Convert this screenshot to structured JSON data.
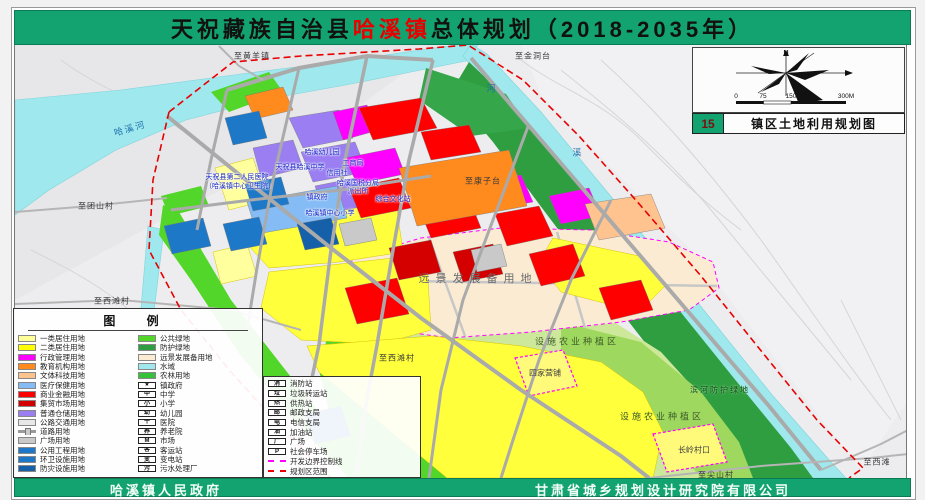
{
  "title": {
    "part1": "天祝藏族自治县",
    "highlight": "哈溪镇",
    "part2": "总体规划（2018-2035年）"
  },
  "footer": {
    "left": "哈溪镇人民政府",
    "right": "甘肃省城乡规划设计研究院有限公司"
  },
  "inset": {
    "north_label": "N",
    "scale_ticks": [
      "0",
      "75",
      "150",
      "300M"
    ],
    "sheet_number": "15",
    "sheet_title": "镇区土地利用规划图"
  },
  "colors": {
    "banner_green": "#12A370",
    "boundary_red": "#E80000",
    "control_line_magenta": "#FF00FF",
    "water_cyan": "#9FE8EE",
    "reserve_cream": "#FBEBD3"
  },
  "legend": {
    "title": "图  例",
    "col1": [
      {
        "label": "一类居住用地",
        "swatch": "#FFFF99"
      },
      {
        "label": "二类居住用地",
        "swatch": "#FFFF00"
      },
      {
        "label": "行政管理用地",
        "swatch": "#FF00FF"
      },
      {
        "label": "教育机构用地",
        "swatch": "#FF8A1E"
      },
      {
        "label": "文体科技用地",
        "swatch": "#FFC390"
      },
      {
        "label": "医疗保健用地",
        "swatch": "#85BCF5"
      },
      {
        "label": "商业金融用地",
        "swatch": "#FF0000"
      },
      {
        "label": "集贸市场用地",
        "swatch": "#D40000"
      },
      {
        "label": "普通仓储用地",
        "swatch": "#9B7FF2"
      },
      {
        "label": "公路交通用地",
        "swatch": "#E8E8E8"
      },
      {
        "label": "道路用地",
        "line": "road"
      },
      {
        "label": "广场用地",
        "swatch": "#C9C9C9"
      },
      {
        "label": "公用工程用地",
        "swatch": "#1E78C8"
      },
      {
        "label": "环卫设施用地",
        "swatch": "#1E78C8"
      },
      {
        "label": "防灾设施用地",
        "swatch": "#1560A8"
      }
    ],
    "col2": [
      {
        "label": "公共绿地",
        "swatch": "#52D629"
      },
      {
        "label": "防护绿地",
        "swatch": "#2F9E41"
      },
      {
        "label": "远景发展备用地",
        "swatch": "#FBEBD3"
      },
      {
        "label": "水域",
        "swatch": "#9FE8EE"
      },
      {
        "label": "农林用地",
        "swatch": "#35C13A"
      },
      {
        "label": "镇政府",
        "icon": "★"
      },
      {
        "label": "中学",
        "icon": "中"
      },
      {
        "label": "小学",
        "icon": "小"
      },
      {
        "label": "幼儿园",
        "icon": "幼"
      },
      {
        "label": "医院",
        "icon": "十"
      },
      {
        "label": "养老院",
        "icon": "养"
      },
      {
        "label": "市场",
        "icon": "M"
      },
      {
        "label": "客运站",
        "icon": "客"
      },
      {
        "label": "变电站",
        "icon": "变"
      },
      {
        "label": "污水处理厂",
        "icon": "污"
      }
    ],
    "col3": [
      {
        "label": "消防站",
        "icon": "消"
      },
      {
        "label": "垃圾转运站",
        "icon": "垃"
      },
      {
        "label": "供热站",
        "icon": "热"
      },
      {
        "label": "邮政支局",
        "icon": "邮"
      },
      {
        "label": "电信支局",
        "icon": "电"
      },
      {
        "label": "加油站",
        "icon": "油"
      },
      {
        "label": "广场",
        "icon": "广"
      },
      {
        "label": "社会停车场",
        "icon": "P"
      },
      {
        "label": "开发边界控制线",
        "line": "magenta-dash"
      },
      {
        "label": "规划区范围",
        "line": "red-dash"
      }
    ]
  },
  "map": {
    "labels": [
      {
        "text": "至黄羊镇",
        "x": 252,
        "y": 56,
        "cls": "place"
      },
      {
        "text": "至金洞台",
        "x": 533,
        "y": 56,
        "cls": "place"
      },
      {
        "text": "至康子台",
        "x": 483,
        "y": 181,
        "cls": "place"
      },
      {
        "text": "至团山村",
        "x": 96,
        "y": 206,
        "cls": "place"
      },
      {
        "text": "至西滩村",
        "x": 112,
        "y": 301,
        "cls": "place"
      },
      {
        "text": "至西滩村",
        "x": 397,
        "y": 358,
        "cls": "place"
      },
      {
        "text": "至尖山村",
        "x": 716,
        "y": 475,
        "cls": "place"
      },
      {
        "text": "至西滩",
        "x": 877,
        "y": 462,
        "cls": "place"
      },
      {
        "text": "远景发展备用地",
        "x": 478,
        "y": 278,
        "cls": "big"
      },
      {
        "text": "设施农业种植区",
        "x": 577,
        "y": 341,
        "cls": "zone"
      },
      {
        "text": "设施农业种植区",
        "x": 662,
        "y": 416,
        "cls": "zone"
      },
      {
        "text": "滨河防护绿地",
        "x": 720,
        "y": 390,
        "cls": "zoneg"
      },
      {
        "text": "四家营铺",
        "x": 545,
        "y": 373,
        "cls": "village"
      },
      {
        "text": "长岭村口",
        "x": 694,
        "y": 450,
        "cls": "village"
      },
      {
        "text": "哈溪河",
        "x": 130,
        "y": 128,
        "cls": "water",
        "r": -16
      },
      {
        "text": "河",
        "x": 492,
        "y": 88,
        "cls": "water"
      },
      {
        "text": "溪",
        "x": 578,
        "y": 152,
        "cls": "water"
      },
      {
        "text": "哈溪幼儿园",
        "x": 322,
        "y": 152,
        "cls": "town"
      },
      {
        "text": "工商局",
        "x": 353,
        "y": 163,
        "cls": "town"
      },
      {
        "text": "信用社",
        "x": 337,
        "y": 173,
        "cls": "town"
      },
      {
        "text": "哈溪国税分局",
        "x": 358,
        "y": 183,
        "cls": "town"
      },
      {
        "text": "派出所",
        "x": 358,
        "y": 191,
        "cls": "town"
      },
      {
        "text": "镇政府",
        "x": 317,
        "y": 197,
        "cls": "town"
      },
      {
        "text": "综合文化站",
        "x": 393,
        "y": 199,
        "cls": "town"
      },
      {
        "text": "天祝县哈溪中学",
        "x": 300,
        "y": 167,
        "cls": "town"
      },
      {
        "text": "天祝县第二人民医院",
        "x": 237,
        "y": 177,
        "cls": "town"
      },
      {
        "text": "（哈溪镇中心卫生院）",
        "x": 240,
        "y": 186,
        "cls": "town"
      },
      {
        "text": "哈溪镇中心小学",
        "x": 330,
        "y": 213,
        "cls": "town"
      }
    ]
  }
}
